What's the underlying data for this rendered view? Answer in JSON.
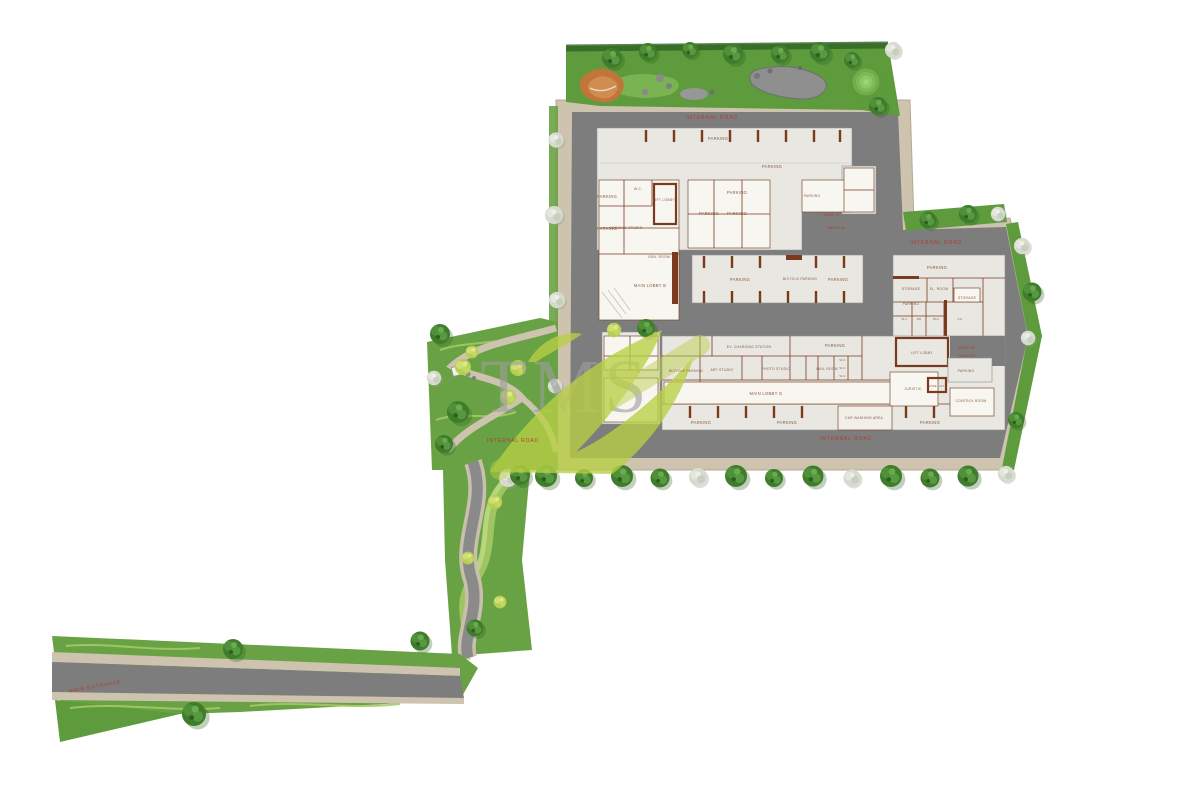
{
  "watermark": {
    "text": "TMS",
    "swoosh_color": "#b9d044",
    "letter_color": "#9e9e9e"
  },
  "roads": {
    "internal_road": "INTERNAL ROAD",
    "main_entrance": "MAIN ENTRANCE",
    "ramp_up": "RAMP UP",
    "ramp_dn": "RAMP DN"
  },
  "rooms": {
    "parking": "PARKING",
    "bicycle_parking": "BICYCLE PARKING",
    "ev_charging_station": "EV. CHARGING STATION",
    "main_lobby_b": "MAIN LOBBY B",
    "main_lobby_g": "MAIN LOBBY G",
    "lift_lobby": "LIFT LOBBY",
    "gen_room": "GEN. ROOM",
    "cooking_studio": "COOKING STUDIO",
    "photo_studio": "PHOTO STUDIO",
    "art_studio": "ART STUDIO",
    "mail_room": "MAIL ROOM",
    "storage": "STORAGE",
    "el_room": "EL. ROOM",
    "control_room": "CONTROL ROOM",
    "juristic": "JURISTIC",
    "car_washing_area": "CAR WASHING AREA",
    "fire_lift": "FIRE LIFT",
    "wc": "W.C.",
    "db": "DB",
    "pau": "PAU",
    "oil": "OIL"
  },
  "colors": {
    "lawn": "#69a244",
    "dark_tree": "#3f7d2c",
    "shrub": "#b6cf52",
    "asphalt": "#7d7d7d",
    "sidewalk": "#cdc3ae",
    "building_plate": "#e9e7e2",
    "wall_brown": "#7b3a1d",
    "road_text_red": "#b5372b",
    "playground_orange": "#c0763a",
    "pond_gray": "#8f8f8f",
    "watermark_lime": "#b9d044"
  }
}
